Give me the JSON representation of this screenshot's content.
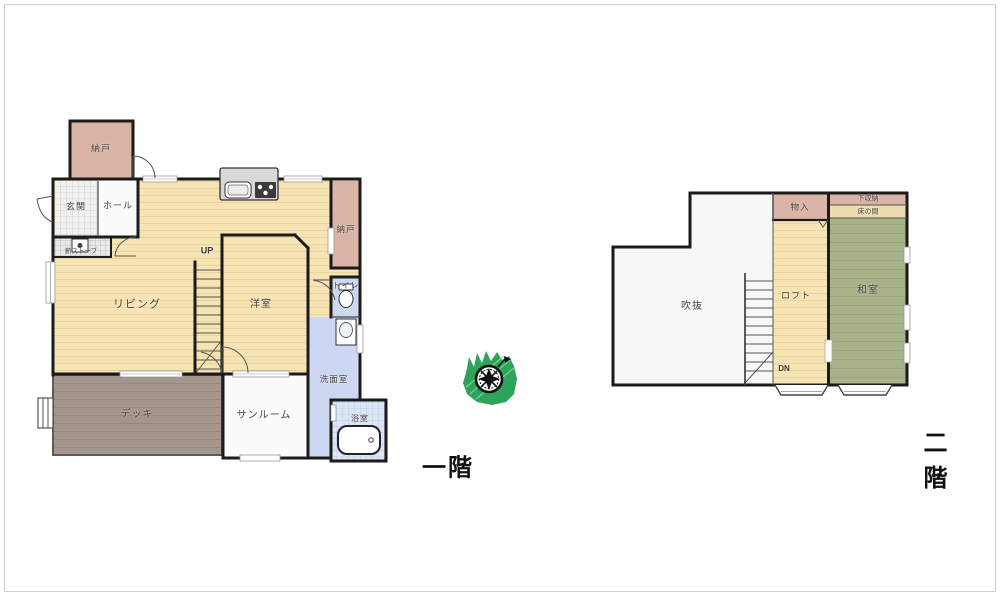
{
  "palette": {
    "wall": "#1b1b1b",
    "floor_yellow": "#f6e4b4",
    "storage_pink": "#d9b4a7",
    "water_blue": "#ccd8f1",
    "bath_blue": "#dde6f6",
    "tatami_green": "#a8b289",
    "deck_brown": "#a5968d",
    "tokonoma_tan": "#ecdcae",
    "compass_green": "#2ea35a"
  },
  "floor1": {
    "title": "一階",
    "rooms": {
      "nando1": "納戸",
      "genkan": "玄関",
      "hall": "ホール",
      "stove": "薪ストーブ",
      "living": "リビング",
      "up": "UP",
      "youshitsu": "洋室",
      "nando2": "納戸",
      "toilet": "トイレ",
      "senmen": "洗面室",
      "bath": "浴室",
      "sunroom": "サンルーム",
      "deck": "デッキ"
    }
  },
  "floor2": {
    "title": "二階",
    "rooms": {
      "fukinuke": "吹抜",
      "monoire": "物入",
      "loft": "ロフト",
      "dn": "DN",
      "shitashuno": "下収納",
      "tokonoma": "床の間",
      "washitsu": "和室"
    }
  }
}
